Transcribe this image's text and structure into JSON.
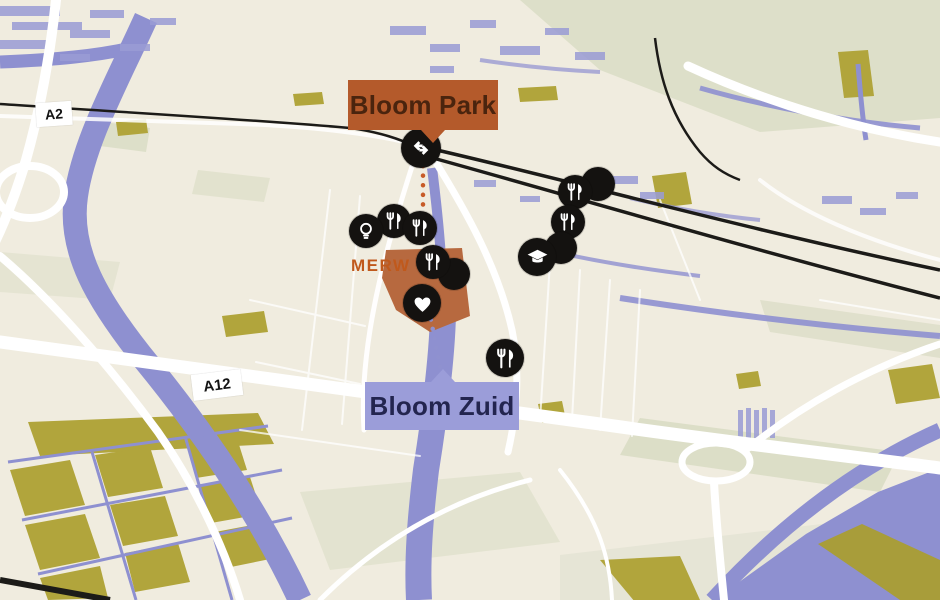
{
  "page": {
    "width": 940,
    "height": 600,
    "kind": "stylized area map"
  },
  "map": {
    "labels": {
      "bloom_park": "Bloom Park",
      "bloom_zuid": "Bloom Zuid",
      "district": "MERW",
      "road_a2": "A2",
      "road_a12": "A12"
    },
    "colors": {
      "land": "#f0ecdf",
      "water": "#8e90d0",
      "sage": "#d8dcc3",
      "olive": "#b1a53c",
      "railway": "#1c1b18",
      "marker": "#141210",
      "park_callout": "#b45a2b",
      "park_text": "#4a240e",
      "zuid_callout": "#9b9dd9",
      "zuid_text": "#23254f",
      "district_fill": "#b7693f",
      "district_text": "#c0591c",
      "connector_park_dots": "#c75b28",
      "connector_zuid_dots": "#8f91cf"
    },
    "markers": [
      {
        "icon": "train-station-icon"
      },
      {
        "icon": "restaurant-icon"
      },
      {
        "icon": "lightbulb-icon"
      },
      {
        "icon": "restaurant-icon"
      },
      {
        "icon": "poi-icon"
      },
      {
        "icon": "restaurant-icon"
      },
      {
        "icon": "heart-icon"
      },
      {
        "icon": "poi-icon"
      },
      {
        "icon": "restaurant-icon"
      },
      {
        "icon": "restaurant-icon"
      },
      {
        "icon": "poi-icon"
      },
      {
        "icon": "education-icon"
      },
      {
        "icon": "restaurant-icon"
      }
    ]
  }
}
